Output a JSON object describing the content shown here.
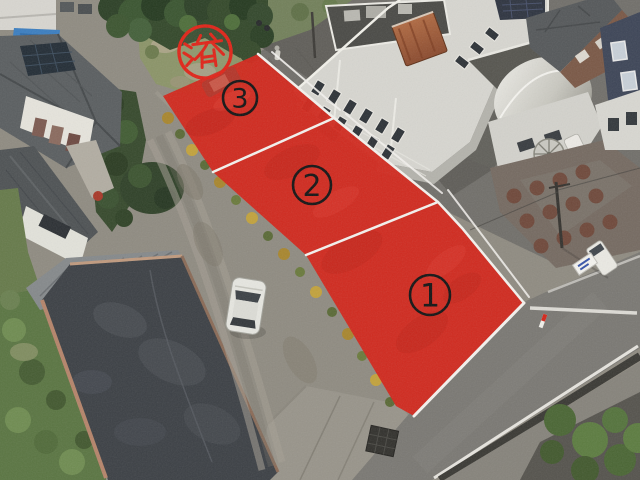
{
  "colors": {
    "lot_red": "#d2271c",
    "lot_mottle": "#a81c12",
    "lot_line_white": "#f4f2ee",
    "badge_black": "#141414",
    "stamp_red": "#e02418"
  },
  "lots": [
    {
      "number": "1"
    },
    {
      "number": "2"
    },
    {
      "number": "3"
    }
  ],
  "stamp": {
    "text": "済"
  }
}
